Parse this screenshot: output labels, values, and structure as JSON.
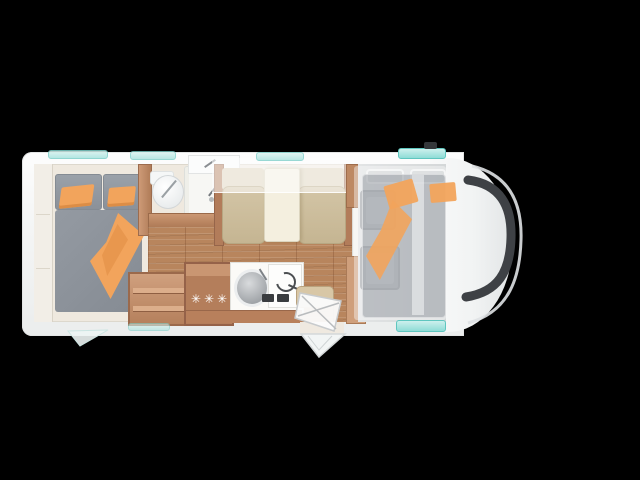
{
  "scene": {
    "description": "Motorhome floor plan, top-down view on black background",
    "background": "#000000"
  },
  "labels": {
    "fridge_stars": "✳✳✳"
  },
  "colors": {
    "bg": "#000000",
    "accent-orange": "#f2a45c",
    "wood": "#c08a66",
    "floor-wood": "#b8855d",
    "floor-cream": "#efe9df",
    "cushion-tan": "#c9ba97",
    "mattress-gray": "#8e949c",
    "window-teal": "#a8e3de",
    "windshield-dark": "#3e4145",
    "table-cream": "#f4efdf",
    "body-white": "#f5f6f6"
  },
  "features": [
    {
      "name": "rear-bedroom",
      "items": [
        "double-bed",
        "gray-mattress",
        "orange-pillows",
        "orange-blanket",
        "wardrobe"
      ]
    },
    {
      "name": "bathroom",
      "items": [
        "toilet",
        "shower-tray",
        "washbasin",
        "wood-door"
      ]
    },
    {
      "name": "kitchen",
      "items": [
        "three-star-fridge",
        "round-sink",
        "hob-with-coil",
        "open-shelf"
      ]
    },
    {
      "name": "dinette",
      "items": [
        "bench-seat-left",
        "bench-seat-right",
        "table",
        "drop-down-bunk"
      ]
    },
    {
      "name": "cab",
      "items": [
        "driver-seat",
        "passenger-seat",
        "drop-down-bed",
        "windshield",
        "roof-vent"
      ]
    },
    {
      "name": "entrance",
      "items": [
        "open-door",
        "entry-step",
        "stool"
      ]
    }
  ]
}
